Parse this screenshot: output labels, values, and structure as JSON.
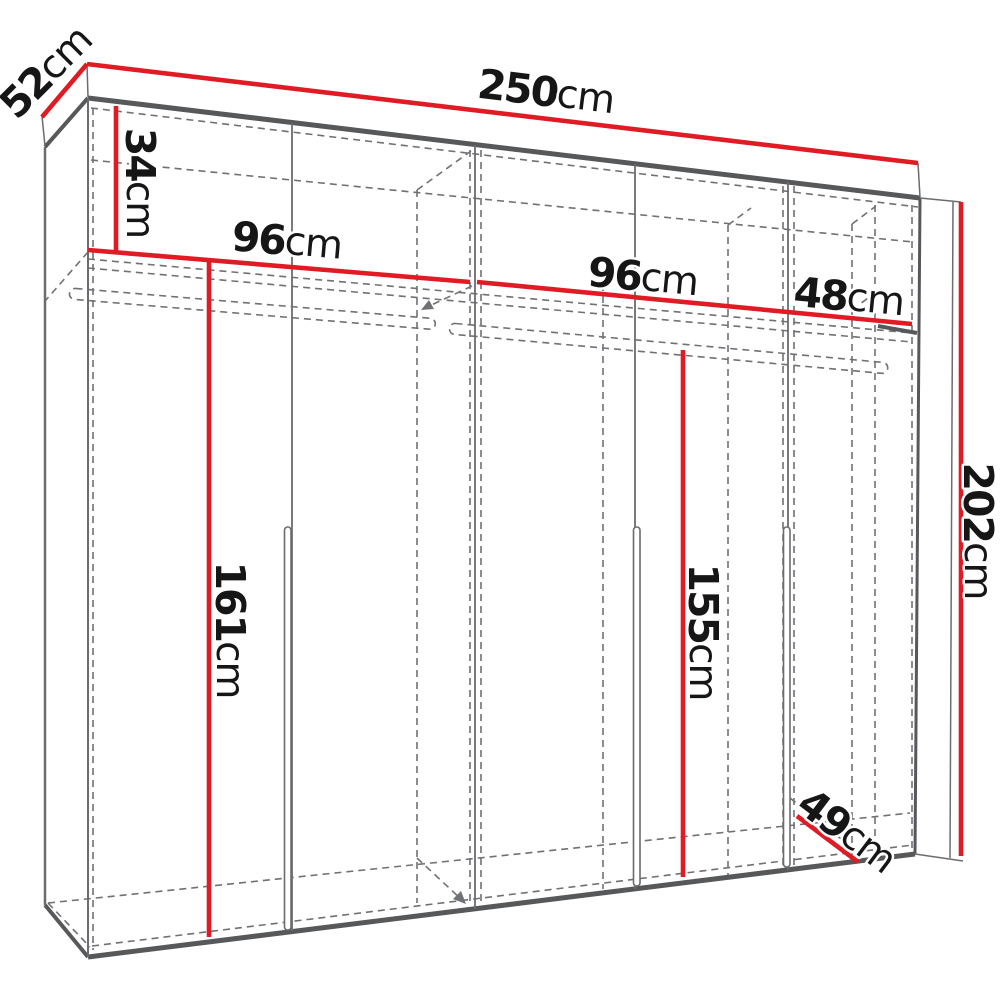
{
  "diagram": {
    "title": "wardrobe-dimension-diagram",
    "unit": "cm",
    "colors": {
      "dimension_red": "#e01b24",
      "outline_dark": "#57585a",
      "outline_mid": "#6b6c6e",
      "hidden_dash": "#707174",
      "label": "#161616",
      "background": "#ffffff"
    },
    "labels": {
      "depth_top": {
        "number": "52",
        "unit": "cm",
        "value": 52
      },
      "width_total": {
        "number": "250",
        "unit": "cm",
        "value": 250
      },
      "top_shelf_height": {
        "number": "34",
        "unit": "cm",
        "value": 34
      },
      "section_left_width": {
        "number": "96",
        "unit": "cm",
        "value": 96
      },
      "section_mid_width": {
        "number": "96",
        "unit": "cm",
        "value": 96
      },
      "section_right_width": {
        "number": "48",
        "unit": "cm",
        "value": 48
      },
      "height_total": {
        "number": "202",
        "unit": "cm",
        "value": 202
      },
      "hanging_left_height": {
        "number": "161",
        "unit": "cm",
        "value": 161
      },
      "hanging_right_height": {
        "number": "155",
        "unit": "cm",
        "value": 155
      },
      "depth_bottom": {
        "number": "49",
        "unit": "cm",
        "value": 49
      }
    }
  }
}
